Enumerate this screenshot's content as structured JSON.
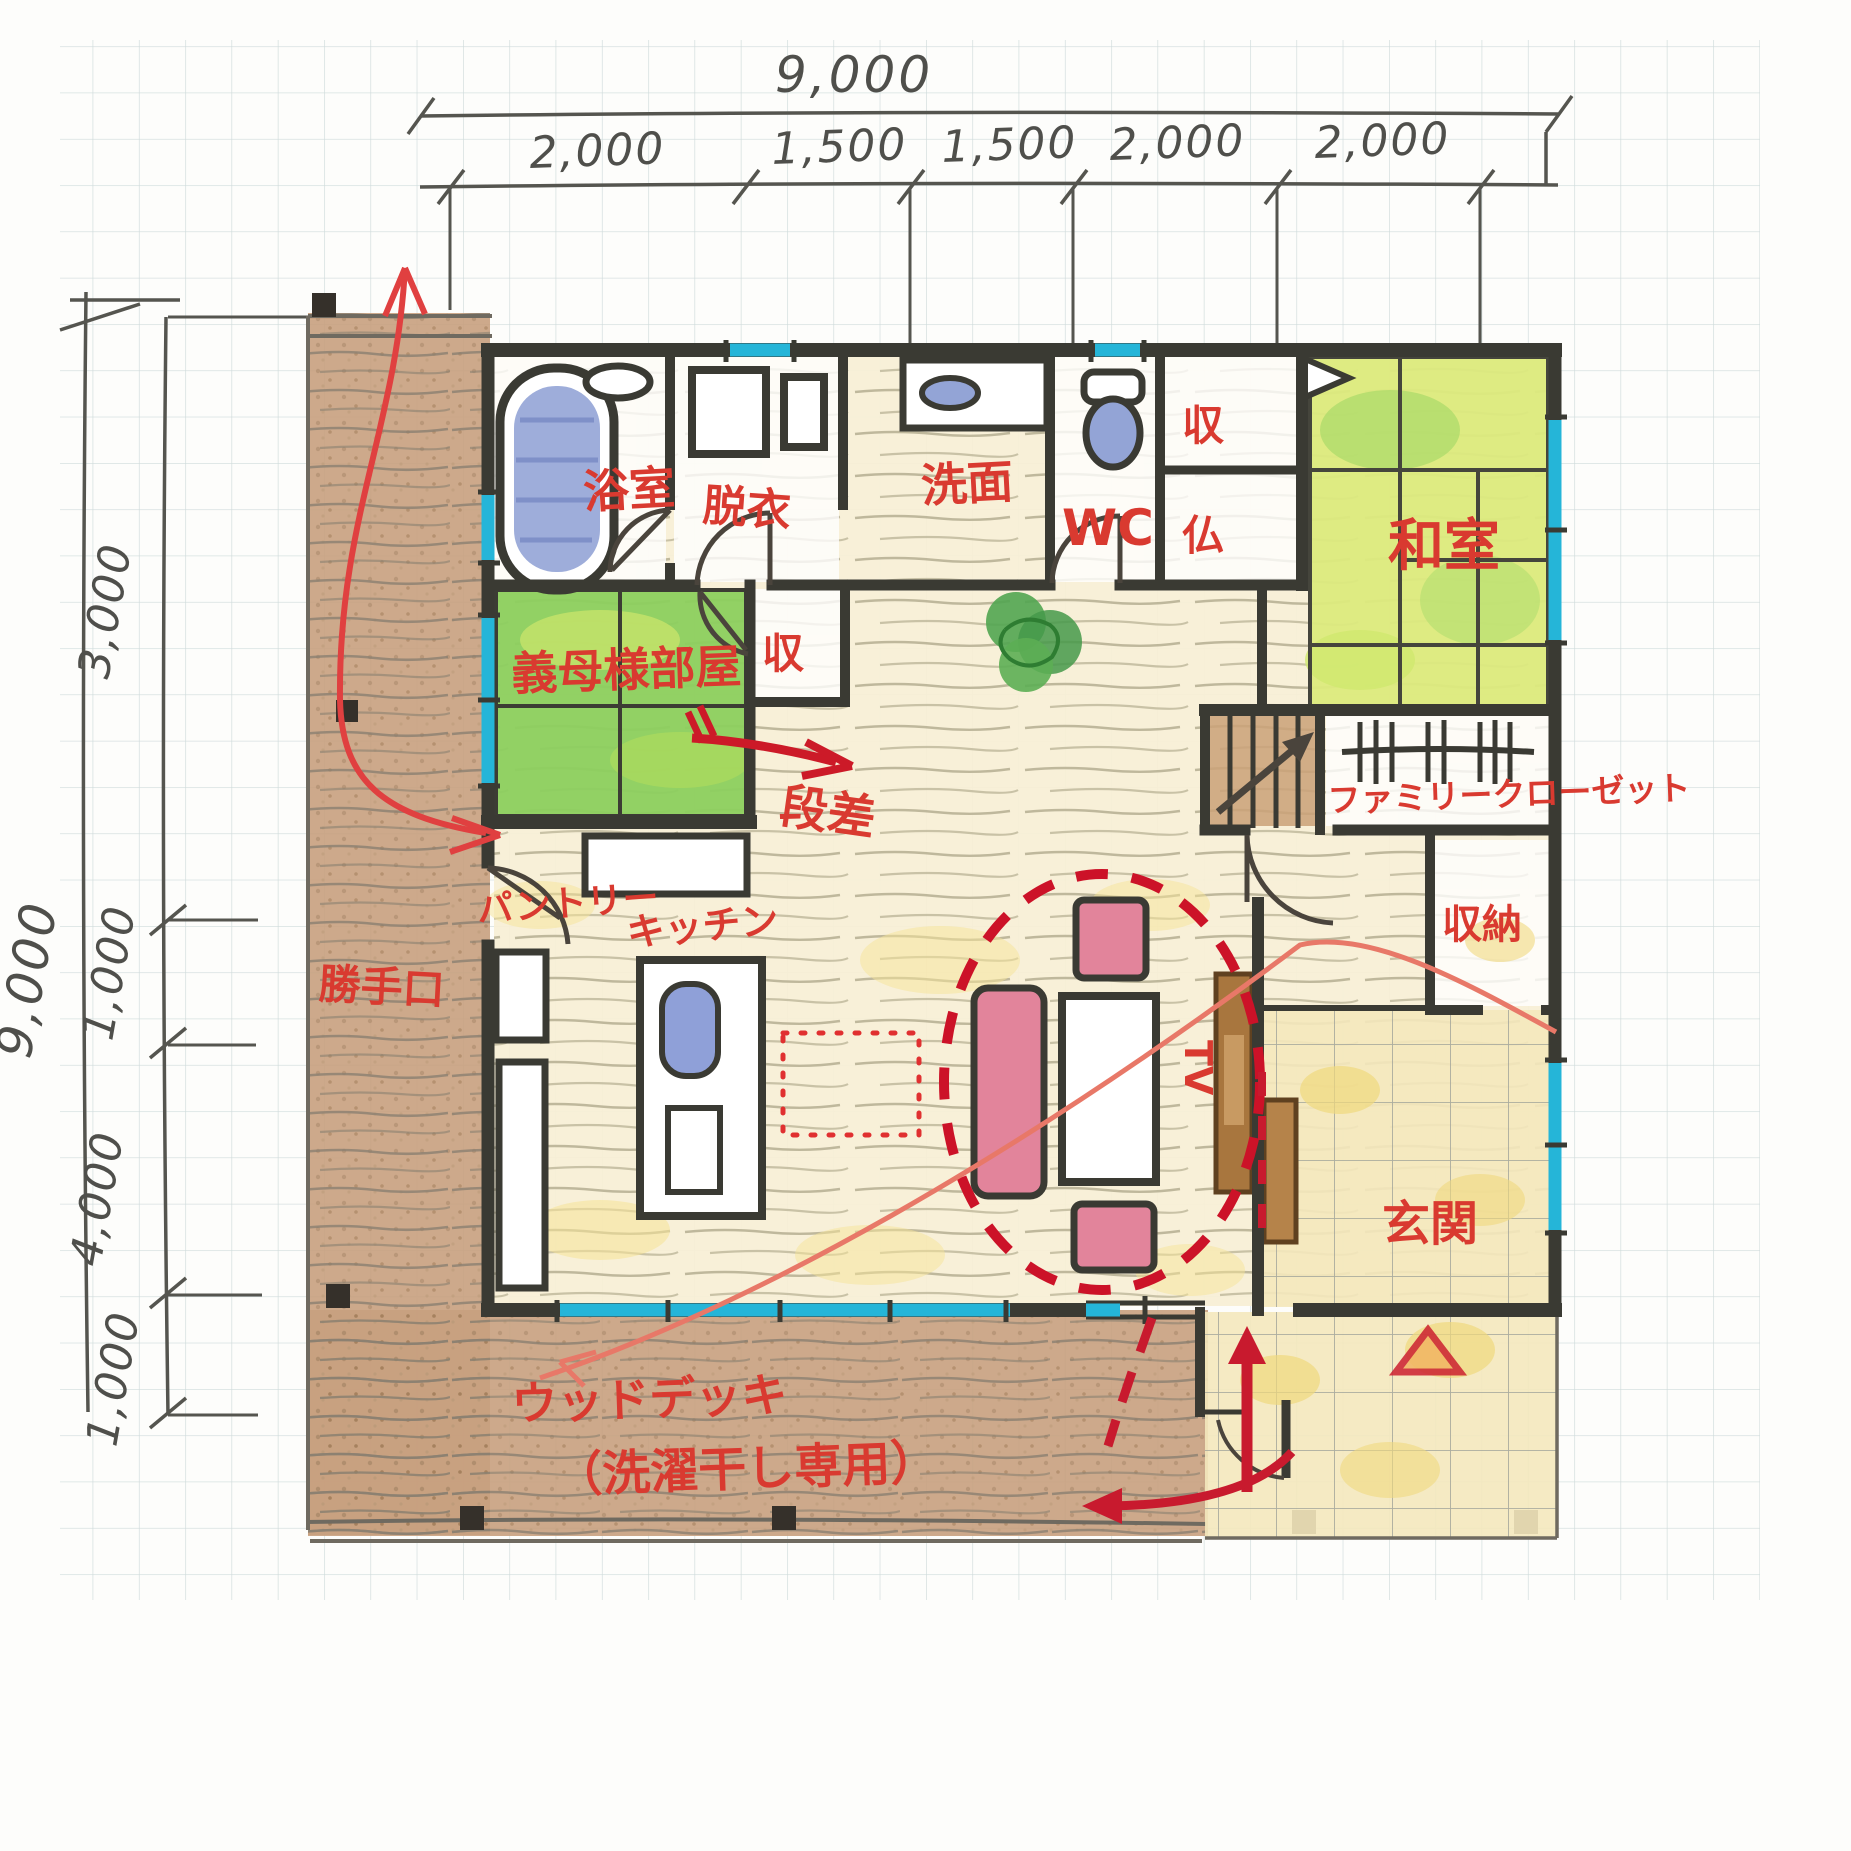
{
  "dimensions": {
    "top": {
      "total": "9,000",
      "segments": [
        "2,000",
        "1,500",
        "1,500",
        "2,000",
        "2,000"
      ]
    },
    "left": {
      "total": "9,000",
      "segments": [
        "3,000",
        "1,000",
        "4,000",
        "1,000"
      ]
    }
  },
  "labels": {
    "bath": "浴室",
    "dressing": "脱衣",
    "washroom": "洗面",
    "wc": "WC",
    "closet_upper": "収",
    "butsudan": "仏",
    "washitsu": "和室",
    "mother_room": "義母様部屋",
    "closet_mid": "収",
    "step": "段差",
    "family_closet": "ファミリークローゼット",
    "pantry": "パントリー",
    "kitchen": "キッチン",
    "back_door": "勝手口",
    "storage": "収納",
    "tv": "TV",
    "genkan": "玄関",
    "deck_line1": "ウッドデッキ",
    "deck_line2": "（洗濯干し専用）"
  },
  "colors": {
    "wall": "#3a3a33",
    "window_cyan": "#25b5d8",
    "label_red": "#d93a30",
    "annotation_red": "#c81a2e",
    "tatami_green": "#8ccf5e",
    "tatami_yellow_green": "#dcea7d",
    "water_blue": "#93a4d6",
    "deck_brown": "#c8a07e",
    "floor_cream": "#f7efd5",
    "tile_yellow": "#f4e8bc",
    "furniture_pink": "#e2849b",
    "wood_brown": "#a8763e"
  }
}
